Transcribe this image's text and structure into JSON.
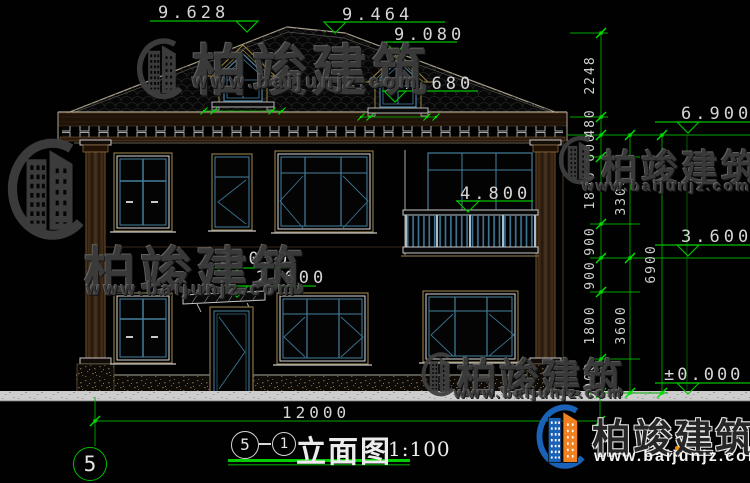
{
  "drawing": {
    "elevations": {
      "ridge_left": "9.628",
      "ridge_right": "9.464",
      "dormer_top": "9.080",
      "dormer_base": "7.680",
      "eave": "6.900",
      "balcony_rail": "4.800",
      "canopy_top": "3.050",
      "canopy_bottom": "2.600",
      "second_floor": "3.600",
      "ground": "±0.000"
    },
    "dims": {
      "right_inner": [
        "2248",
        "480",
        "600",
        "1800",
        "900",
        "900",
        "1800",
        "900"
      ],
      "right_middle": [
        "3300",
        "3600"
      ],
      "right_outer": [
        "6900"
      ],
      "bottom_total": "12000"
    },
    "axis": {
      "left_bubble": "5"
    },
    "title_block": {
      "bubble_left": "5",
      "bubble_right": "1",
      "name": "立面图",
      "scale": "1:100"
    }
  },
  "watermark": {
    "brand": "柏竣建筑",
    "url": "www.baijunjz.com"
  }
}
